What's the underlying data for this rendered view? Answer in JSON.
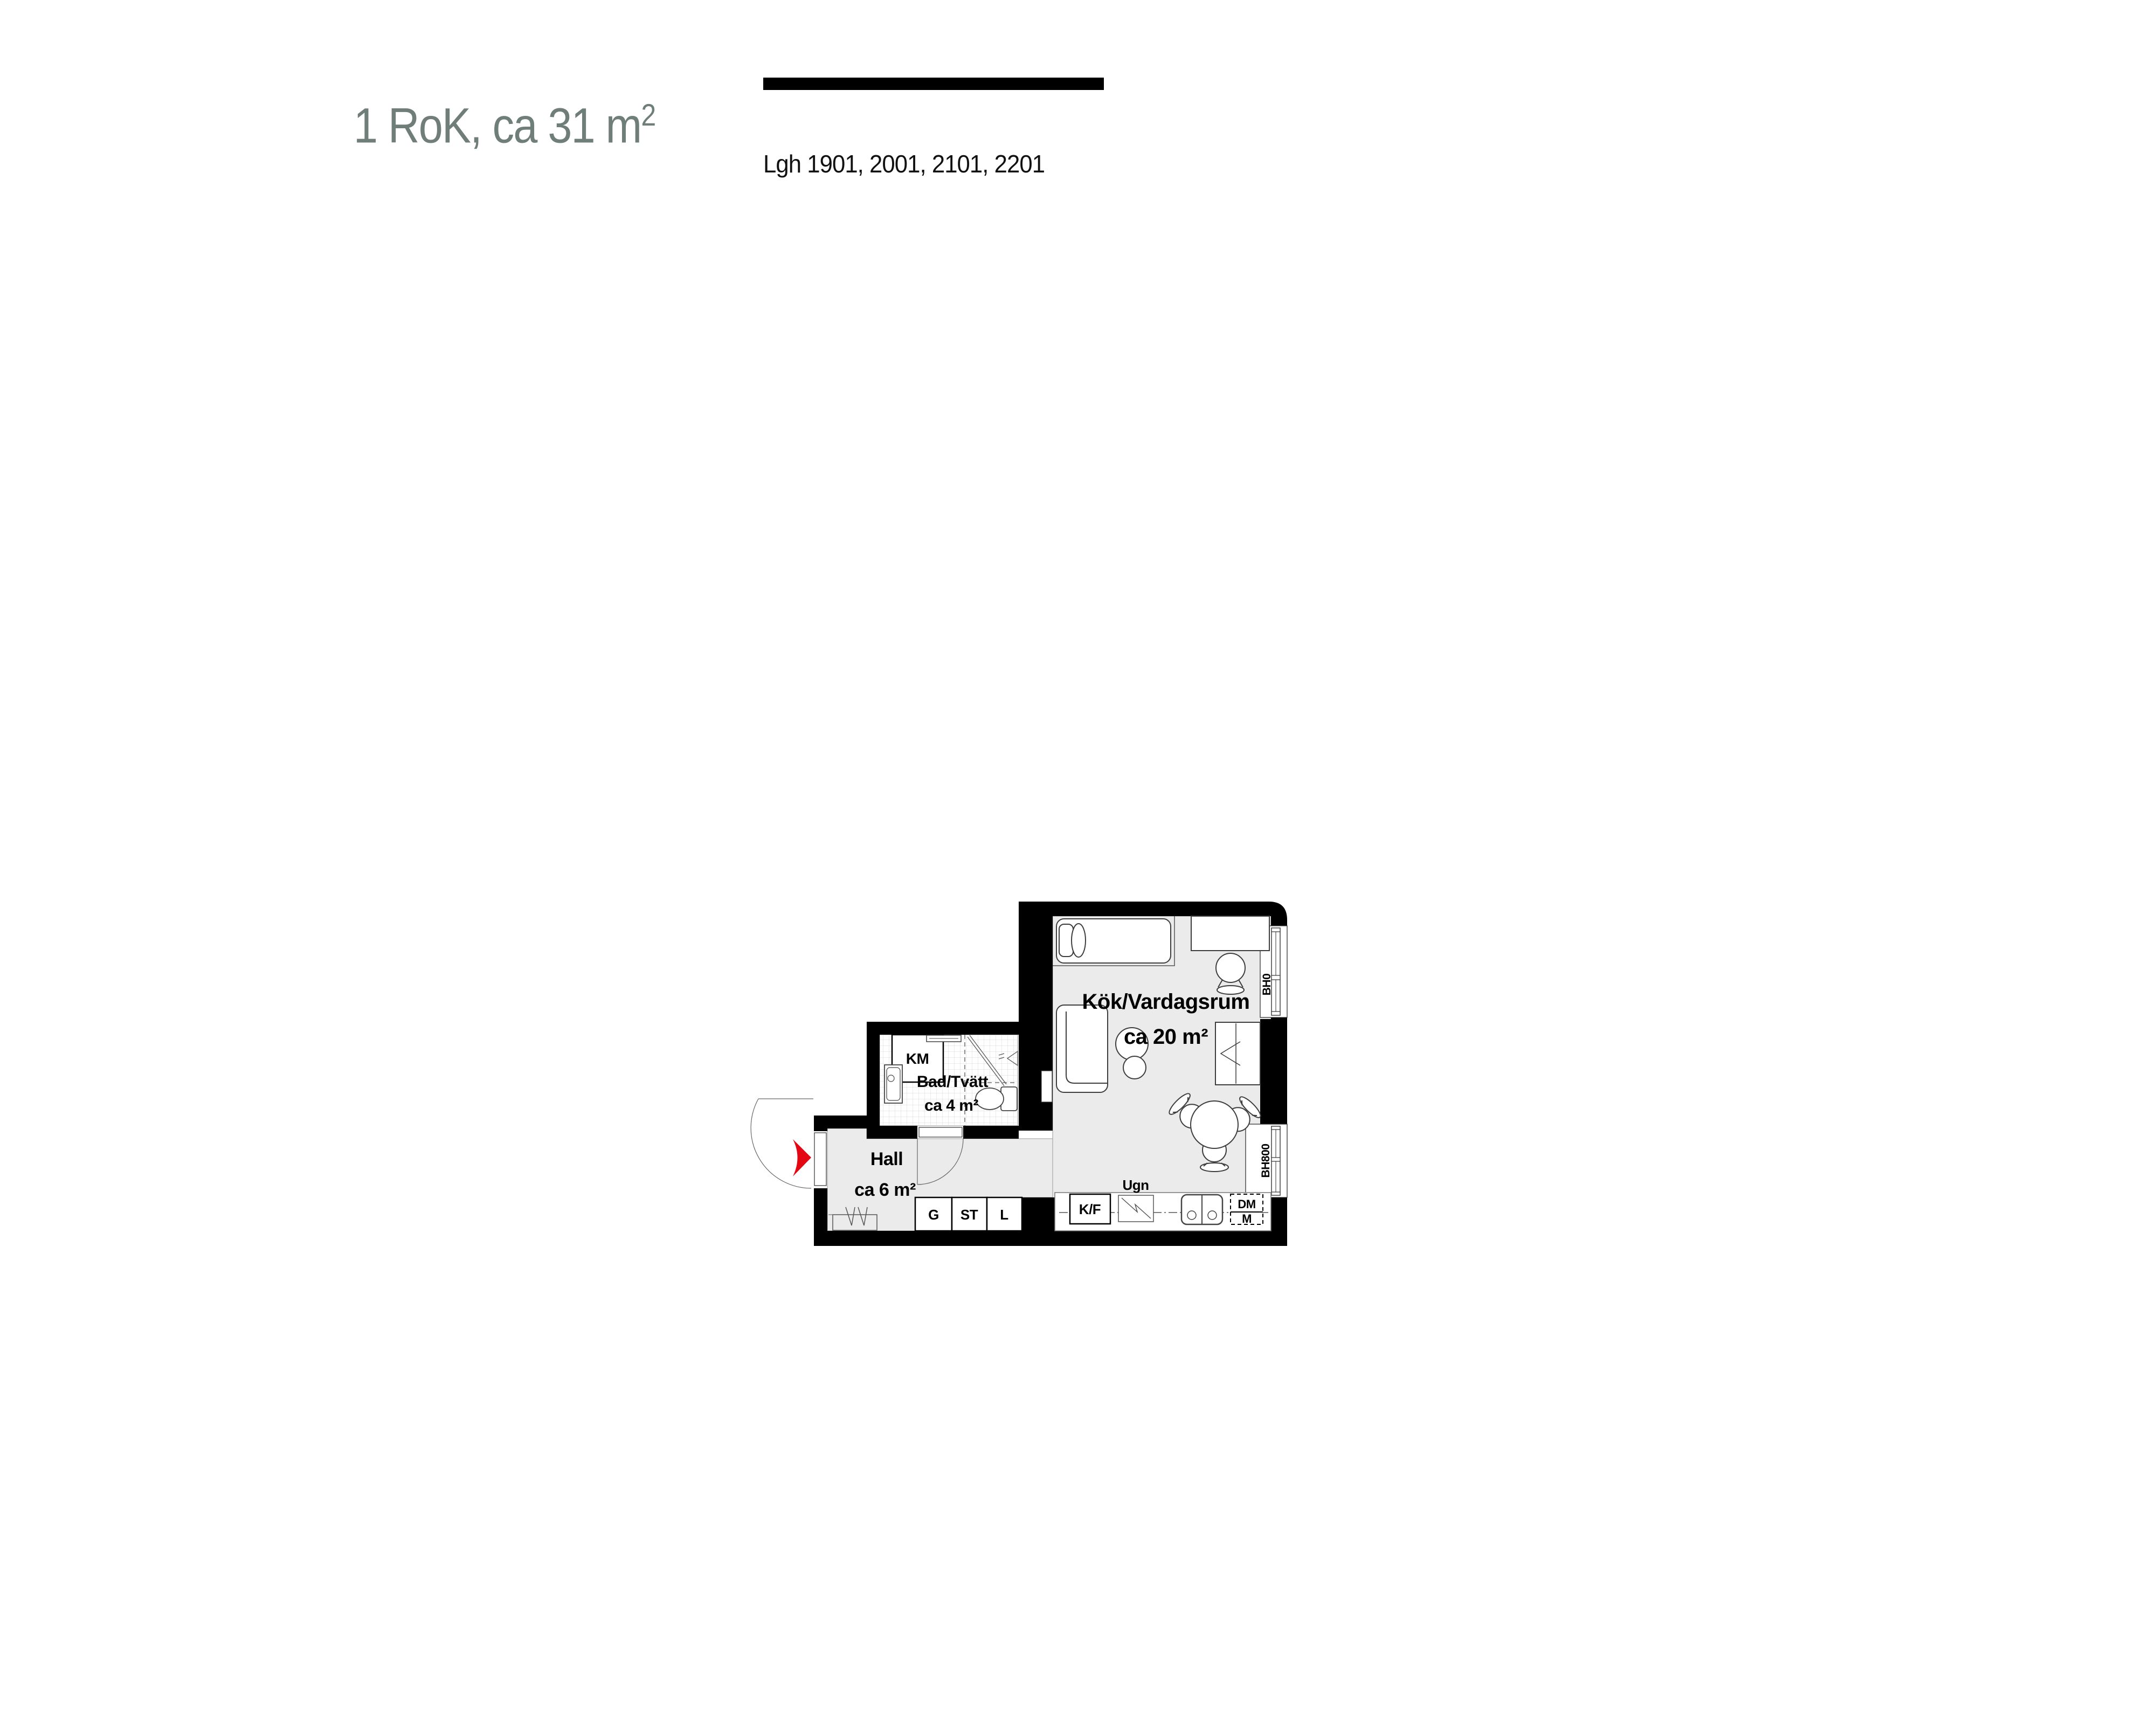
{
  "header": {
    "title_main": "1 RoK, ca 31 m",
    "title_sup": "2",
    "apartments": "Lgh 1901, 2001, 2101, 2201"
  },
  "plan": {
    "rooms": {
      "kitchen_living": {
        "name": "Kök/Vardagsrum",
        "area": "ca 20 m²"
      },
      "bath": {
        "name": "Bad/Tvätt",
        "area": "ca 4 m²"
      },
      "hall": {
        "name": "Hall",
        "area": "ca 6 m²"
      }
    },
    "appliances": {
      "km": "KM",
      "kf": "K/F",
      "ugn": "Ugn",
      "dm": "DM",
      "m": "M",
      "g": "G",
      "st": "ST",
      "l": "L"
    },
    "windows": {
      "top": "BH0",
      "bottom": "BH800"
    }
  },
  "colors": {
    "accent_red": "#e30613",
    "title_green": "#6f7e78",
    "floor_gray": "#ebebeb",
    "wall_black": "#000000"
  }
}
